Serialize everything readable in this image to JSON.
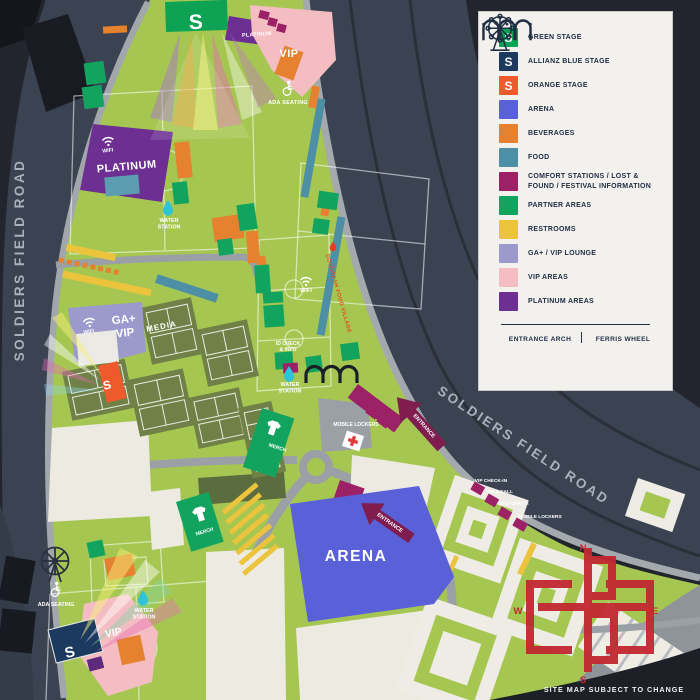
{
  "scene": {
    "bg": "#22252e",
    "road": "#3b4252",
    "green": "#a5c751",
    "path_gray": "#9aa0a6",
    "cream": "#edeae2",
    "logo_red": "#c22730"
  },
  "legend": {
    "items": [
      {
        "label": "GREEN STAGE",
        "color": "#0da254",
        "glyph": "S"
      },
      {
        "label": "ALLIANZ BLUE STAGE",
        "color": "#1c3a60",
        "glyph": "S"
      },
      {
        "label": "ORANGE STAGE",
        "color": "#ee5a2b",
        "glyph": "S"
      },
      {
        "label": "ARENA",
        "color": "#5a60d8"
      },
      {
        "label": "BEVERAGES",
        "color": "#e5812f"
      },
      {
        "label": "FOOD",
        "color": "#4d90a5"
      },
      {
        "label": "COMFORT STATIONS / LOST & FOUND / FESTIVAL INFORMATION",
        "color": "#9c2166"
      },
      {
        "label": "PARTNER AREAS",
        "color": "#12a45e"
      },
      {
        "label": "RESTROOMS",
        "color": "#ecc33d"
      },
      {
        "label": "GA+ / VIP LOUNGE",
        "color": "#9c99cd"
      },
      {
        "label": "VIP AREAS",
        "color": "#f4bdc2"
      },
      {
        "label": "PLATINUM AREAS",
        "color": "#6d3092"
      }
    ],
    "footer": [
      {
        "label": "ENTRANCE ARCH",
        "icon": "entrance-arch-icon"
      },
      {
        "label": "FERRIS WHEEL",
        "icon": "ferris-wheel-icon"
      }
    ]
  },
  "map": {
    "labels": [
      {
        "id": "road-left",
        "lines": [
          "SOLDIERS FIELD ROAD"
        ],
        "x": 24,
        "y": 260,
        "rot": -90,
        "size": 13.5,
        "color": "#a9b1bd",
        "ls": 2.5
      },
      {
        "id": "road-right",
        "lines": [
          "SOLDIERS FIELD ROAD"
        ],
        "x": 521,
        "y": 449,
        "rot": 33.5,
        "size": 13.5,
        "color": "#a9b1bd",
        "ls": 2.5
      },
      {
        "id": "green-stage-s",
        "lines": [
          "S"
        ],
        "x": 196,
        "y": 29,
        "rot": -2,
        "size": 21
      },
      {
        "id": "orange-stage-s",
        "lines": [
          "S"
        ],
        "x": 108,
        "y": 389,
        "rot": -14,
        "size": 12
      },
      {
        "id": "blue-stage-s",
        "lines": [
          "S"
        ],
        "x": 71,
        "y": 657,
        "rot": -14,
        "size": 15
      },
      {
        "id": "platinum-badge",
        "lines": [
          "PLATINUM"
        ],
        "x": 257,
        "y": 36,
        "rot": -4,
        "size": 5.4,
        "ls": 0.3
      },
      {
        "id": "vip-top",
        "lines": [
          "VIP"
        ],
        "x": 289,
        "y": 57,
        "size": 11,
        "ls": 0.5
      },
      {
        "id": "ada-top",
        "lines": [
          "ADA SEATING"
        ],
        "x": 288,
        "y": 104,
        "size": 5.4,
        "ls": 0.3
      },
      {
        "id": "wifi-platinum",
        "lines": [
          "WIFI"
        ],
        "x": 108,
        "y": 152,
        "rot": -6,
        "size": 5.2
      },
      {
        "id": "platinum-main",
        "lines": [
          "PLATINUM"
        ],
        "x": 127,
        "y": 170,
        "rot": -5,
        "size": 11,
        "ls": 0.5
      },
      {
        "id": "water-1",
        "lines": [
          "WATER",
          "STATION"
        ],
        "x": 169,
        "y": 222,
        "size": 5.4
      },
      {
        "id": "ga-vip",
        "lines": [
          "GA+",
          "VIP"
        ],
        "x": 124,
        "y": 323,
        "rot": -6,
        "size": 11.5
      },
      {
        "id": "wifi-ga",
        "lines": [
          "WIFI"
        ],
        "x": 89,
        "y": 333,
        "rot": -10,
        "size": 5
      },
      {
        "id": "media",
        "lines": [
          "MEDIA"
        ],
        "x": 162,
        "y": 329,
        "rot": -11,
        "size": 8,
        "ls": 1
      },
      {
        "id": "wifi-field",
        "lines": [
          "WIFI"
        ],
        "x": 306,
        "y": 292,
        "size": 5.6
      },
      {
        "id": "doordash-strip",
        "lines": [
          "DOORDASH FOOD VILLAGE"
        ],
        "x": 337,
        "y": 294,
        "rot": 74,
        "size": 5.4,
        "color": "#e8481e",
        "ls": 0.4
      },
      {
        "id": "id-check",
        "lines": [
          "ID CHECK",
          "& INFO"
        ],
        "x": 288,
        "y": 345,
        "size": 5
      },
      {
        "id": "water-2",
        "lines": [
          "WATER",
          "STATION"
        ],
        "x": 290,
        "y": 386,
        "size": 5.4
      },
      {
        "id": "merch-1",
        "lines": [
          "MERCH"
        ],
        "x": 277,
        "y": 449,
        "rot": 18,
        "size": 5
      },
      {
        "id": "mobile-lockers-1",
        "lines": [
          "MOBILE LOCKERS"
        ],
        "x": 356,
        "y": 426,
        "size": 5
      },
      {
        "id": "entrance-1",
        "lines": [
          "ENTRANCE"
        ],
        "x": 423,
        "y": 427,
        "rot": 48,
        "size": 5.4
      },
      {
        "id": "arena",
        "lines": [
          "ARENA"
        ],
        "x": 356,
        "y": 561,
        "size": 15.5,
        "ls": 1.5
      },
      {
        "id": "entrance-2",
        "lines": [
          "ENTRANCE"
        ],
        "x": 389,
        "y": 524,
        "rot": 35,
        "size": 5.4
      },
      {
        "id": "merch-2",
        "lines": [
          "MERCH"
        ],
        "x": 205,
        "y": 533,
        "rot": -17,
        "size": 5
      },
      {
        "id": "vip-check-in",
        "lines": [
          "VIP CHECK-IN"
        ],
        "x": 491,
        "y": 482,
        "size": 4.8
      },
      {
        "id": "will-call",
        "lines": [
          "WILL CALL"
        ],
        "x": 500,
        "y": 493,
        "size": 4.8
      },
      {
        "id": "box-office",
        "lines": [
          "BOX OFFICE"
        ],
        "x": 514,
        "y": 505,
        "size": 4.8
      },
      {
        "id": "mobile-lockers-2",
        "lines": [
          "MOBILE LOCKERS"
        ],
        "x": 540,
        "y": 518,
        "size": 4.8
      },
      {
        "id": "ada-2",
        "lines": [
          "ADA SEATING"
        ],
        "x": 56,
        "y": 606,
        "size": 5.4
      },
      {
        "id": "water-3",
        "lines": [
          "WATER",
          "STATION"
        ],
        "x": 144,
        "y": 612,
        "size": 5.4
      },
      {
        "id": "vip-bottom",
        "lines": [
          "VIP"
        ],
        "x": 114,
        "y": 636,
        "rot": -10,
        "size": 10.5
      },
      {
        "id": "compass-n",
        "lines": [
          "N"
        ],
        "x": 583,
        "y": 551,
        "size": 9.5,
        "color": "#c22730"
      },
      {
        "id": "compass-e",
        "lines": [
          "E"
        ],
        "x": 655,
        "y": 614,
        "size": 9.5,
        "color": "#c22730"
      },
      {
        "id": "compass-s",
        "lines": [
          "S"
        ],
        "x": 583,
        "y": 683,
        "size": 9.5,
        "color": "#c22730"
      },
      {
        "id": "compass-w",
        "lines": [
          "W"
        ],
        "x": 518,
        "y": 614,
        "size": 9.5,
        "color": "#c22730"
      },
      {
        "id": "site-note",
        "lines": [
          "SITE MAP SUBJECT TO CHANGE"
        ],
        "x": 614,
        "y": 692,
        "size": 7.2,
        "color": "#eef0f2",
        "ls": 1
      }
    ]
  }
}
